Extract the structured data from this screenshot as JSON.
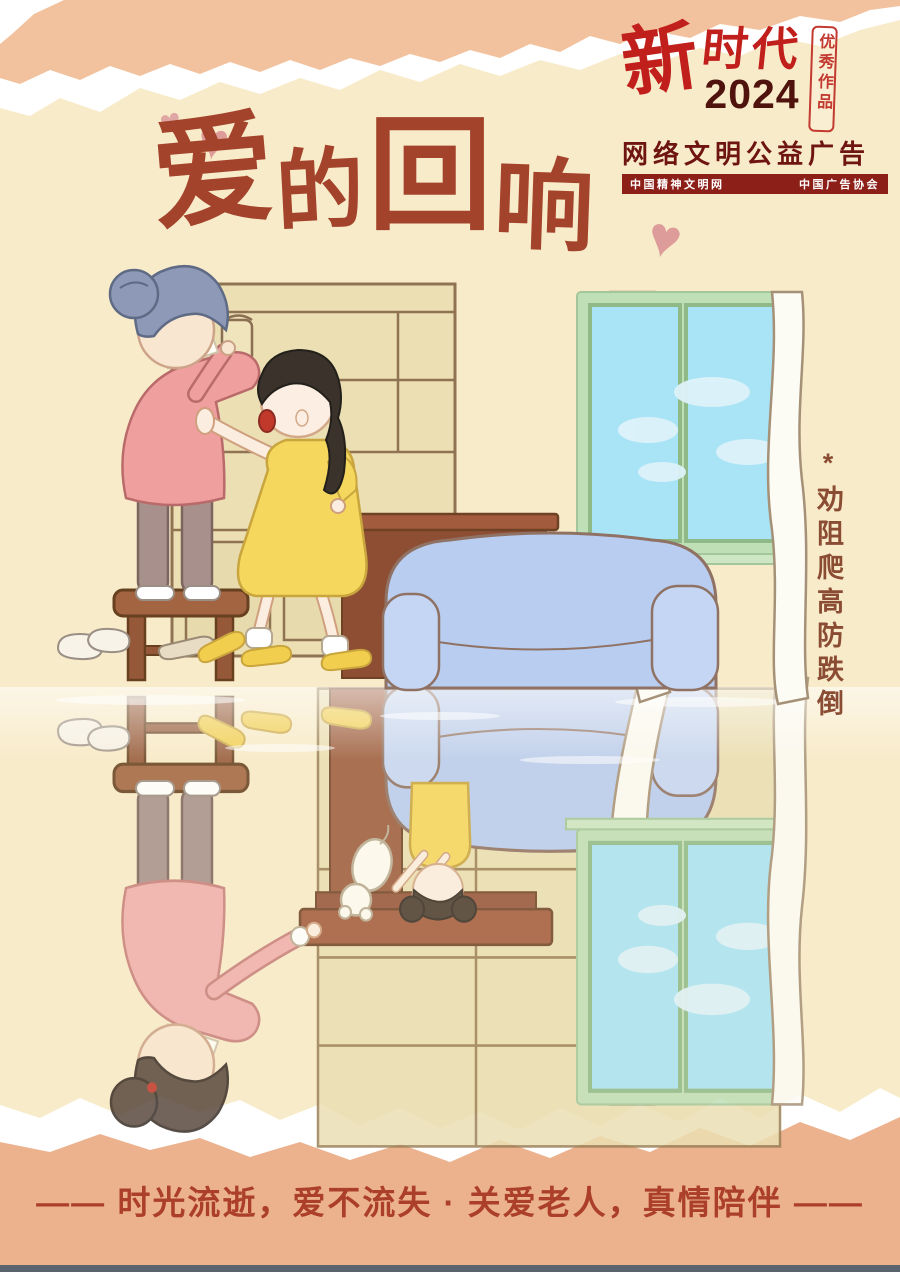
{
  "badge": {
    "brand_char": "新",
    "brand_rest": "时代",
    "year": "2024",
    "seal": "优秀作品",
    "campaign": "网络文明公益广告",
    "org_left": "中国精神文明网",
    "org_right": "中国广告协会"
  },
  "title": {
    "chars": [
      "爱",
      "的",
      "回",
      "响"
    ]
  },
  "hearts": [
    "♥",
    "♥",
    "♥"
  ],
  "side_note": "*劝阻爬高防跌倒",
  "slogan": "—— 时光流逝，爱不流失 · 关爱老人，真情陪伴 ——",
  "colors": {
    "background": "#f8ebc9",
    "paper_salmon": "#f2c29e",
    "paper_salmon_bottom": "#ecb28e",
    "title_brown": "#a4432c",
    "slogan_red": "#ab3f29",
    "badge_red": "#c01f1c",
    "badge_dark_maroon": "#4f120d",
    "org_bar_maroon": "#8c1f17",
    "side_note_brown": "#8b4c34",
    "sofa_blue": "#b9cdf1",
    "shelf_tan": "#ebdfb3",
    "table_brown": "#9c5b3e"
  }
}
